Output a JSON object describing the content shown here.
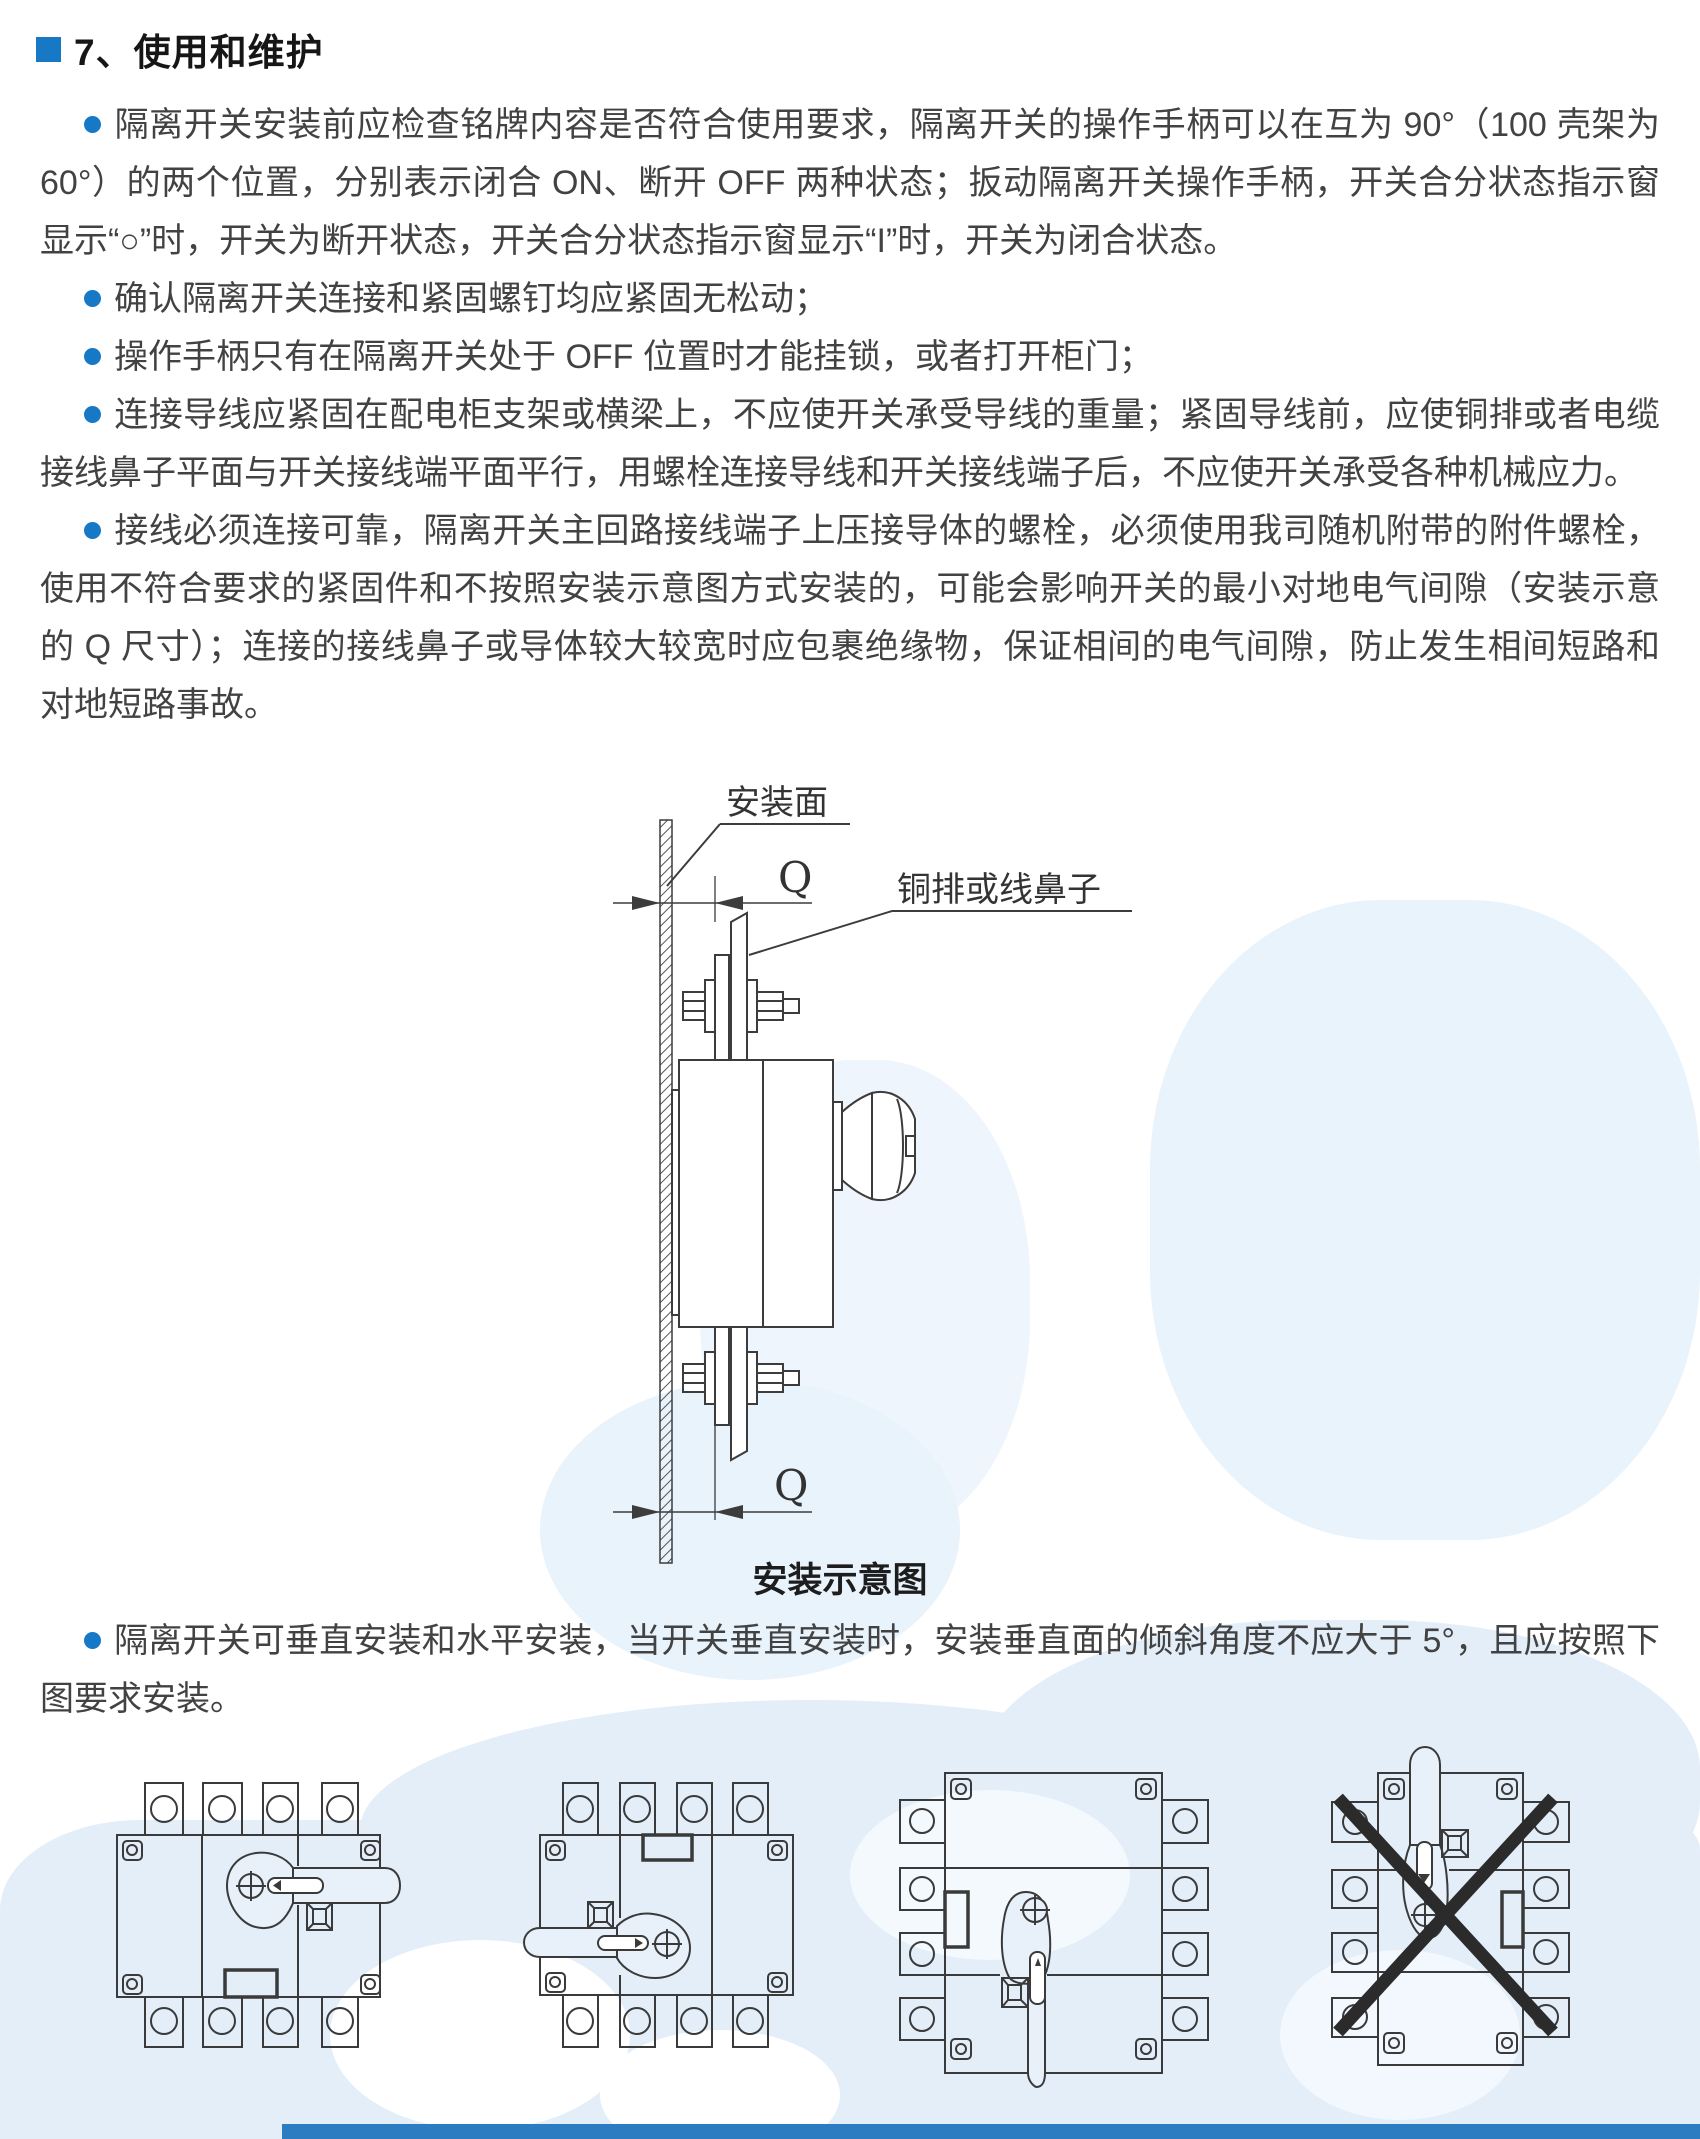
{
  "header": {
    "title": "7、使用和维护"
  },
  "paragraphs": [
    "隔离开关安装前应检查铭牌内容是否符合使用要求，隔离开关的操作手柄可以在互为 90°（100 壳架为 60°）的两个位置，分别表示闭合 ON、断开 OFF 两种状态；扳动隔离开关操作手柄，开关合分状态指示窗显示“○”时，开关为断开状态，开关合分状态指示窗显示“I”时，开关为闭合状态。",
    "确认隔离开关连接和紧固螺钉均应紧固无松动；",
    "操作手柄只有在隔离开关处于 OFF 位置时才能挂锁，或者打开柜门；",
    "连接导线应紧固在配电柜支架或横梁上，不应使开关承受导线的重量；紧固导线前，应使铜排或者电缆接线鼻子平面与开关接线端平面平行，用螺栓连接导线和开关接线端子后，不应使开关承受各种机械应力。",
    "接线必须连接可靠，隔离开关主回路接线端子上压接导体的螺栓，必须使用我司随机附带的附件螺栓，使用不符合要求的紧固件和不按照安装示意图方式安装的，可能会影响开关的最小对地电气间隙（安装示意的 Q 尺寸）；连接的接线鼻子或导体较大较宽时应包裹绝缘物，保证相间的电气间隙，防止发生相间短路和对地短路事故。"
  ],
  "install_note": "隔离开关可垂直安装和水平安装，当开关垂直安装时，安装垂直面的倾斜角度不应大于 5°，且应按照下图要求安装。",
  "diagram": {
    "mounting_surface_label": "安装面",
    "busbar_label": "铜排或线鼻子",
    "dim_top": "Q",
    "dim_bottom": "Q",
    "caption": "安装示意图"
  },
  "figure_icons": [
    "switch-horizontal-handle-right",
    "switch-horizontal-handle-left",
    "switch-vertical-handle-down",
    "switch-vertical-handle-up-forbidden"
  ],
  "colors": {
    "accent_blue": "#1779c5",
    "body_text": "#424242",
    "diagram_line": "#3c3c3c",
    "map_blue": "#e3eef9",
    "footer_blue": "#2c7cc2",
    "forbidden_cross": "#2b2b2b"
  }
}
